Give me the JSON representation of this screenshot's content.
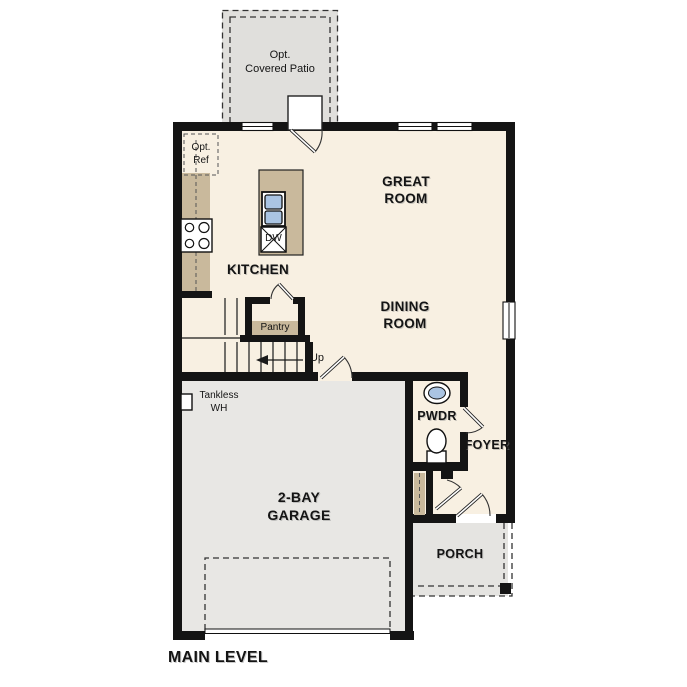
{
  "plan_title": "MAIN LEVEL",
  "rooms": {
    "patio": "Opt.\nCovered Patio",
    "great_room": "GREAT\nROOM",
    "kitchen": "KITCHEN",
    "dining_room": "DINING\nROOM",
    "powder": "PWDR",
    "foyer": "FOYER",
    "garage": "2-BAY\nGARAGE",
    "porch": "PORCH"
  },
  "features": {
    "opt_ref": "Opt.\nRef",
    "dishwasher": "DW",
    "pantry": "Pantry",
    "stair_direction": "Up",
    "water_heater": "Tankless\nWH"
  },
  "colors": {
    "floor": "#f8f0e2",
    "garage_floor": "#e8e7e4",
    "patio_floor": "#e0dfdc",
    "porch_floor": "#e5e4e1",
    "cabinet": "#c9b99c",
    "sink": "#aac4e2",
    "wall": "#141414"
  }
}
